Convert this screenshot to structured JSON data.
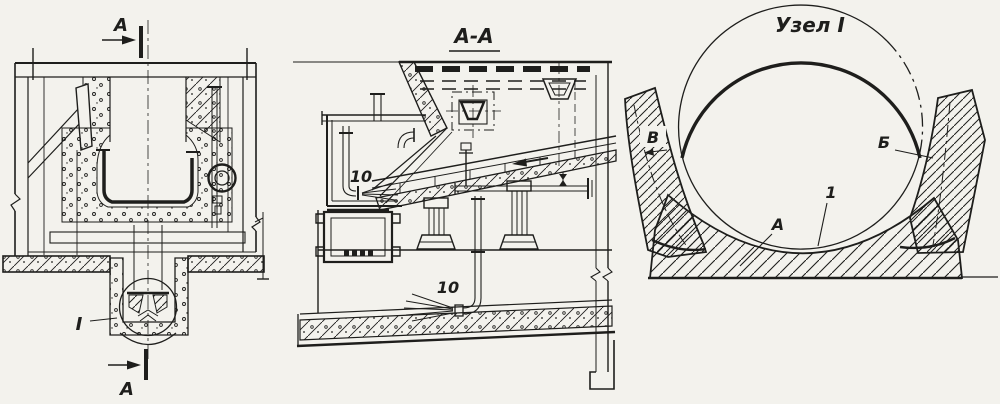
{
  "figure": {
    "kind": "technical engineering drawing, three views of a metallurgical mixer / furnace with bottom ball nozzle",
    "paper_color": "#f3f2ed",
    "ink_color": "#1e1e1c",
    "views": {
      "front_section": {
        "description": "front elevation with section plane marks",
        "cut_label_top": "А",
        "cut_label_bottom": "А",
        "detail_callout": "I"
      },
      "section_aa": {
        "title": "А-А",
        "nozzle_label_upper": "10",
        "nozzle_label_lower": "10"
      },
      "detail_i": {
        "title": "Узел I",
        "gap_left_label": "В",
        "gap_right_label": "Б",
        "lining_label": "А",
        "shell_label": "1"
      }
    }
  }
}
